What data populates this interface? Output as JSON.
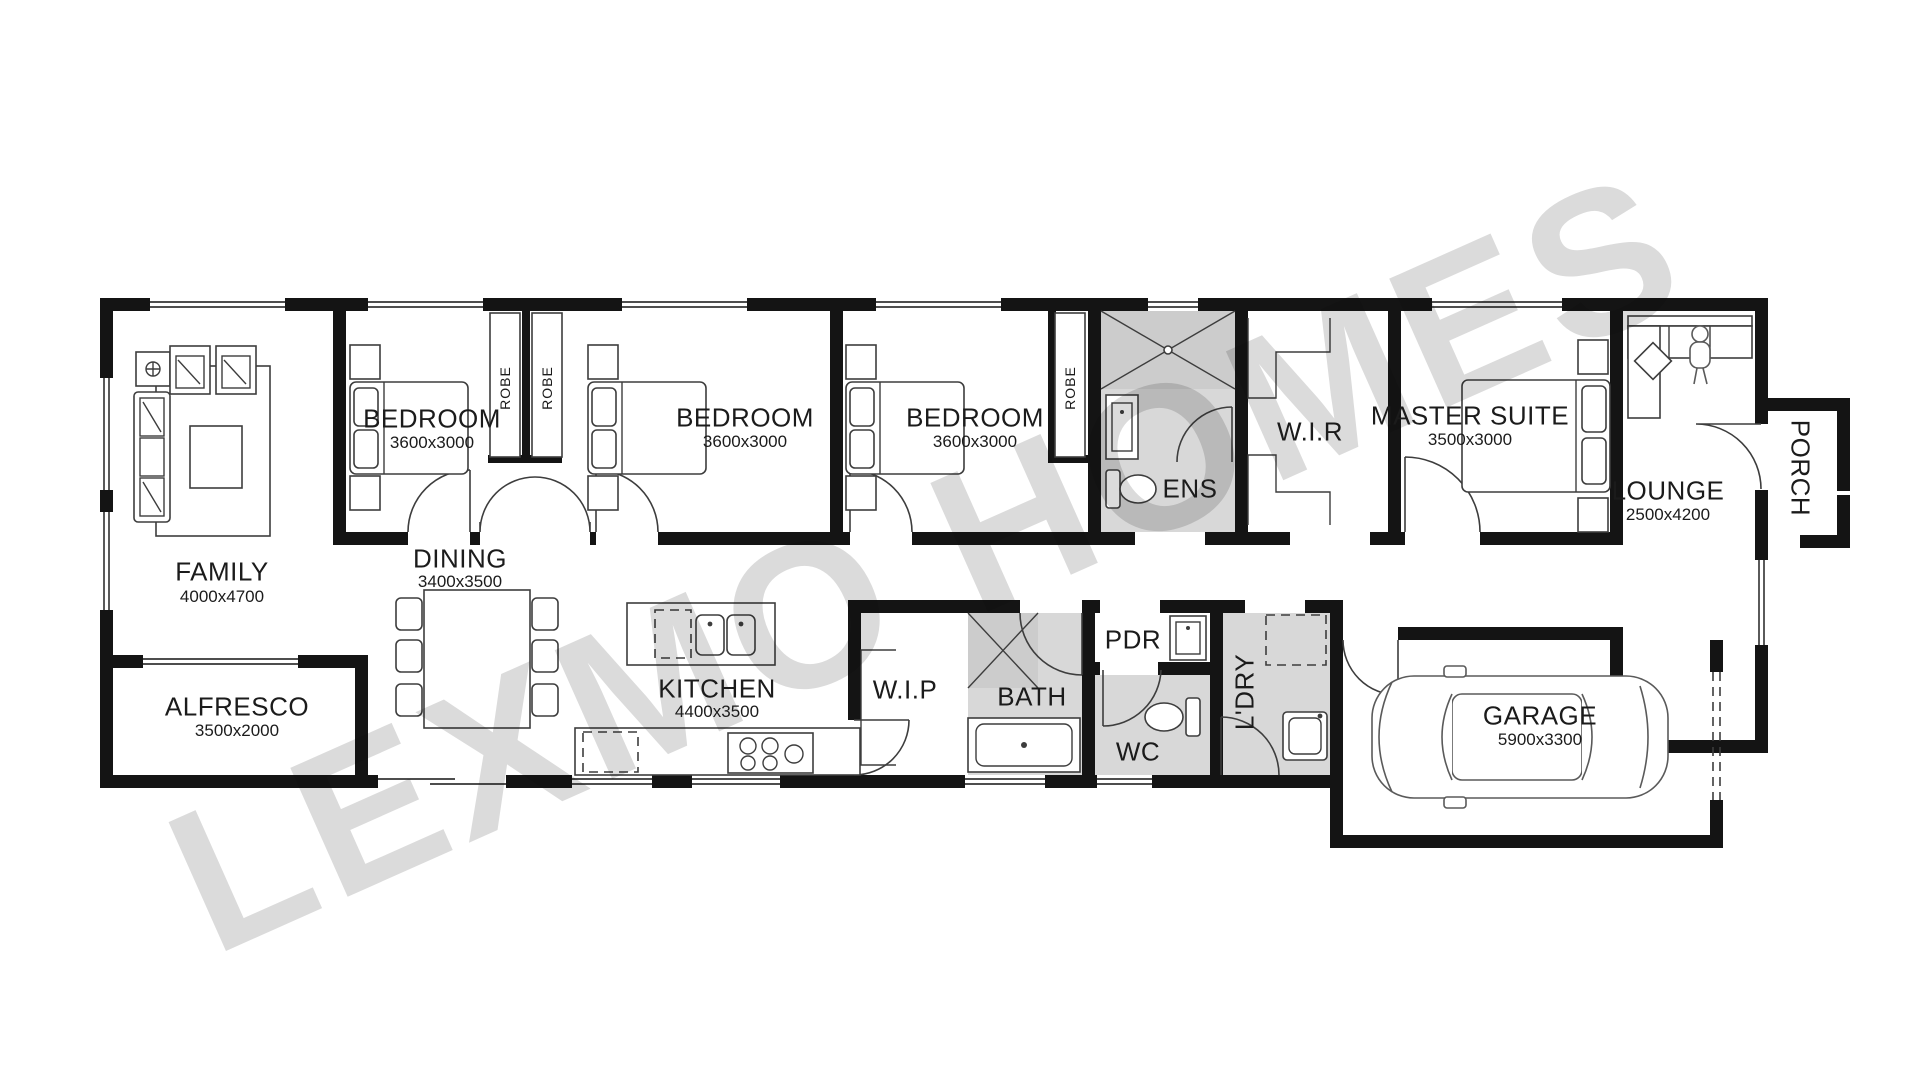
{
  "watermark": {
    "text": "LEXMO HOMES",
    "color": "#dbdbdb"
  },
  "rooms": {
    "family": {
      "name": "FAMILY",
      "dims": "4000x4700"
    },
    "alfresco": {
      "name": "ALFRESCO",
      "dims": "3500x2000"
    },
    "dining": {
      "name": "DINING",
      "dims": "3400x3500"
    },
    "bedroom1": {
      "name": "BEDROOM",
      "dims": "3600x3000"
    },
    "bedroom2": {
      "name": "BEDROOM",
      "dims": "3600x3000"
    },
    "bedroom3": {
      "name": "BEDROOM",
      "dims": "3600x3000"
    },
    "kitchen": {
      "name": "KITCHEN",
      "dims": "4400x3500"
    },
    "wip": {
      "name": "W.I.P"
    },
    "bath": {
      "name": "BATH"
    },
    "wc": {
      "name": "WC"
    },
    "pdr": {
      "name": "PDR"
    },
    "ldry": {
      "name": "L'DRY"
    },
    "ens": {
      "name": "ENS"
    },
    "wir": {
      "name": "W.I.R"
    },
    "master": {
      "name": "MASTER SUITE",
      "dims": "3500x3000"
    },
    "lounge": {
      "name": "LOUNGE",
      "dims": "2500x4200"
    },
    "porch": {
      "name": "PORCH"
    },
    "garage": {
      "name": "GARAGE",
      "dims": "5900x3300"
    },
    "robe": {
      "name": "ROBE"
    }
  },
  "colors": {
    "wall": "#141414",
    "wet_area": "#d8d8d8",
    "line": "#3d3d3d",
    "watermark": "#dbdbdb"
  }
}
